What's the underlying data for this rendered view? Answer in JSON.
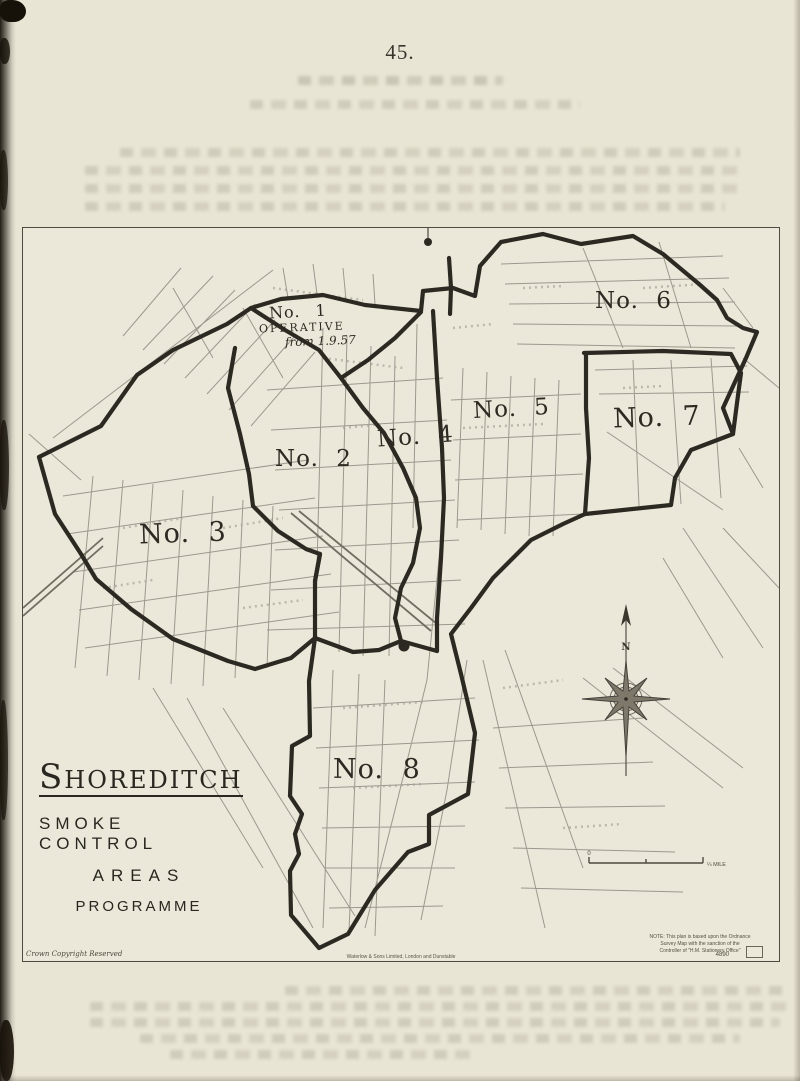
{
  "page": {
    "number": "45."
  },
  "map": {
    "areas": [
      {
        "label": "No. 1",
        "status": "OPERATIVE",
        "status_date": "from 1.9.57"
      },
      {
        "label": "No. 2"
      },
      {
        "label": "No. 3"
      },
      {
        "label": "No. 4"
      },
      {
        "label": "No. 5"
      },
      {
        "label": "No. 6"
      },
      {
        "label": "No. 7"
      },
      {
        "label": "No. 8"
      }
    ],
    "title": {
      "main": "Shoreditch",
      "line2": "SMOKE CONTROL",
      "line3": "AREAS",
      "line4": "PROGRAMME"
    },
    "compass": {
      "north_label": "N"
    },
    "scale_bar": {
      "left_label": "0",
      "right_label": "¼ MILE"
    },
    "note": {
      "line1": "NOTE: This plan is based upon the Ordnance",
      "line2": "Survey Map with the sanction of the",
      "line3": "Controller of \"H.M. Stationery Office\""
    },
    "credits": {
      "copyright": "Crown Copyright Reserved",
      "printer": "Waterlow & Sons Limited, London and Dunstable",
      "ref": "4890"
    }
  }
}
